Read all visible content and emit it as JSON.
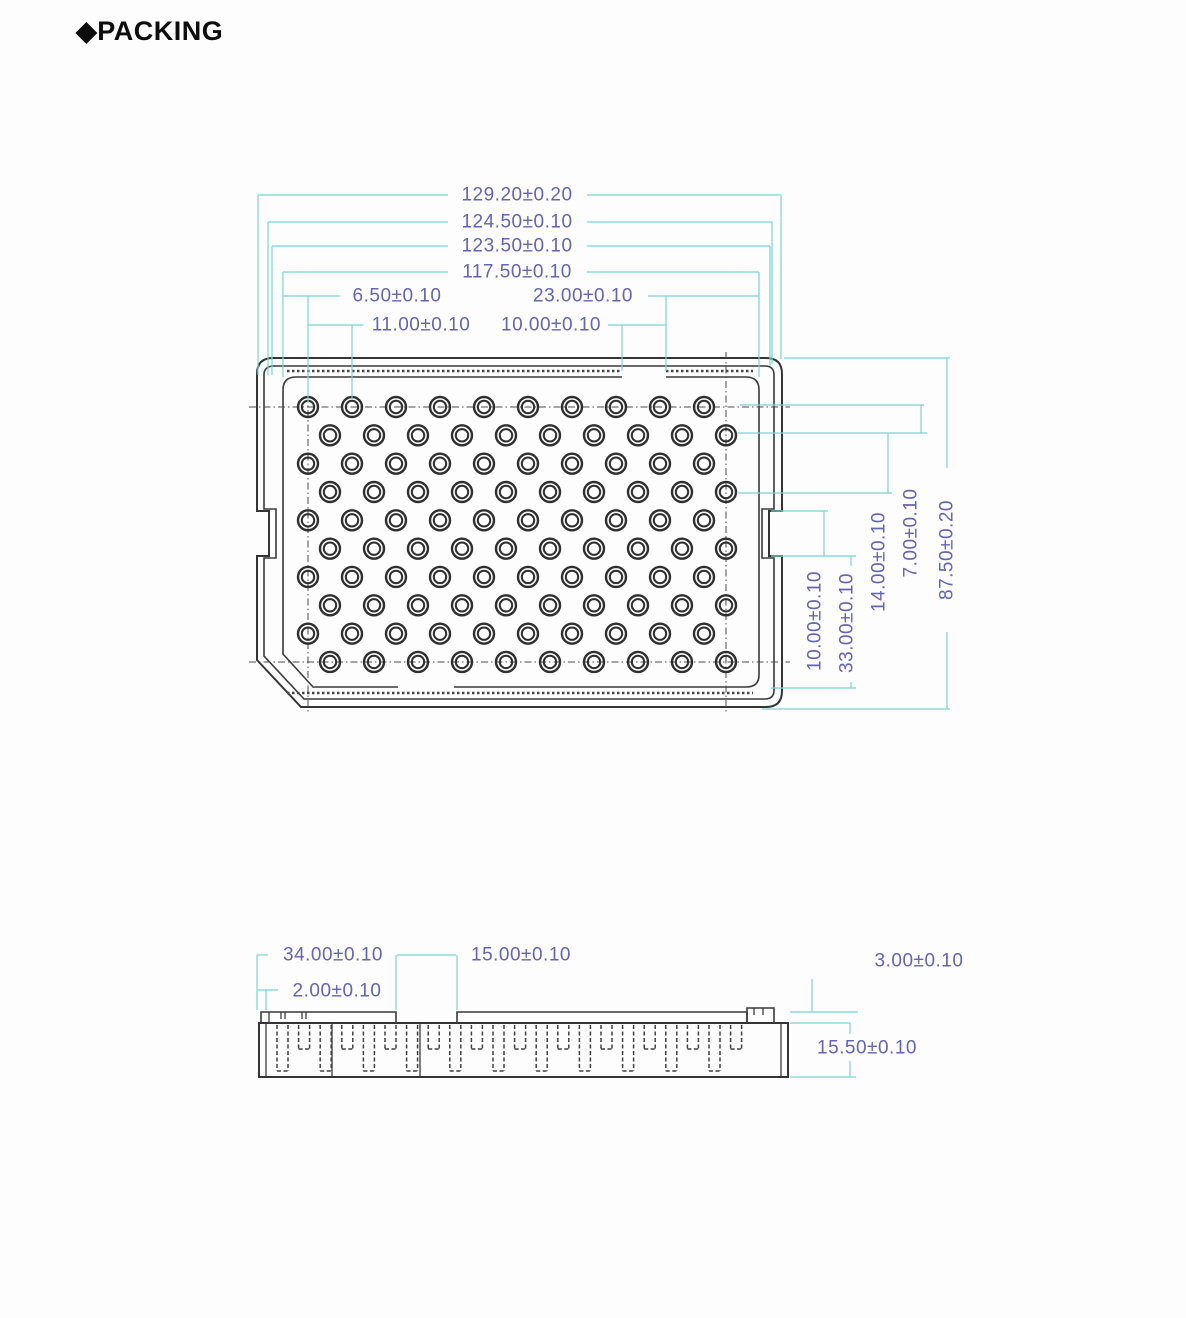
{
  "heading": "◆PACKING",
  "colors": {
    "dimension_line": "#79d4d4",
    "dimension_text": "#6464b0",
    "drawing_line": "#3a3a3a",
    "background": "#ffffff"
  },
  "top_view": {
    "grid": {
      "rows": 10,
      "cols": 10
    },
    "dims": {
      "overall_width": "129.20±0.20",
      "width_2": "124.50±0.10",
      "width_3": "123.50±0.10",
      "width_4": "117.50±0.10",
      "edge_to_hole": "6.50±0.10",
      "hole_pitch": "11.00±0.10",
      "slot_width": "10.00±0.10",
      "slot_to_edge": "23.00±0.10",
      "notch_height": "10.00±0.10",
      "notch_to_bottom": "33.00±0.10",
      "row_pitch_2": "14.00±0.10",
      "row_pitch": "7.00±0.10",
      "overall_height": "87.50±0.20"
    }
  },
  "side_view": {
    "dims": {
      "left_section": "34.00±0.10",
      "end_tab": "2.00±0.10",
      "recess_width": "15.00±0.10",
      "lip_thickness": "3.00±0.10",
      "overall_height": "15.50±0.10"
    }
  }
}
